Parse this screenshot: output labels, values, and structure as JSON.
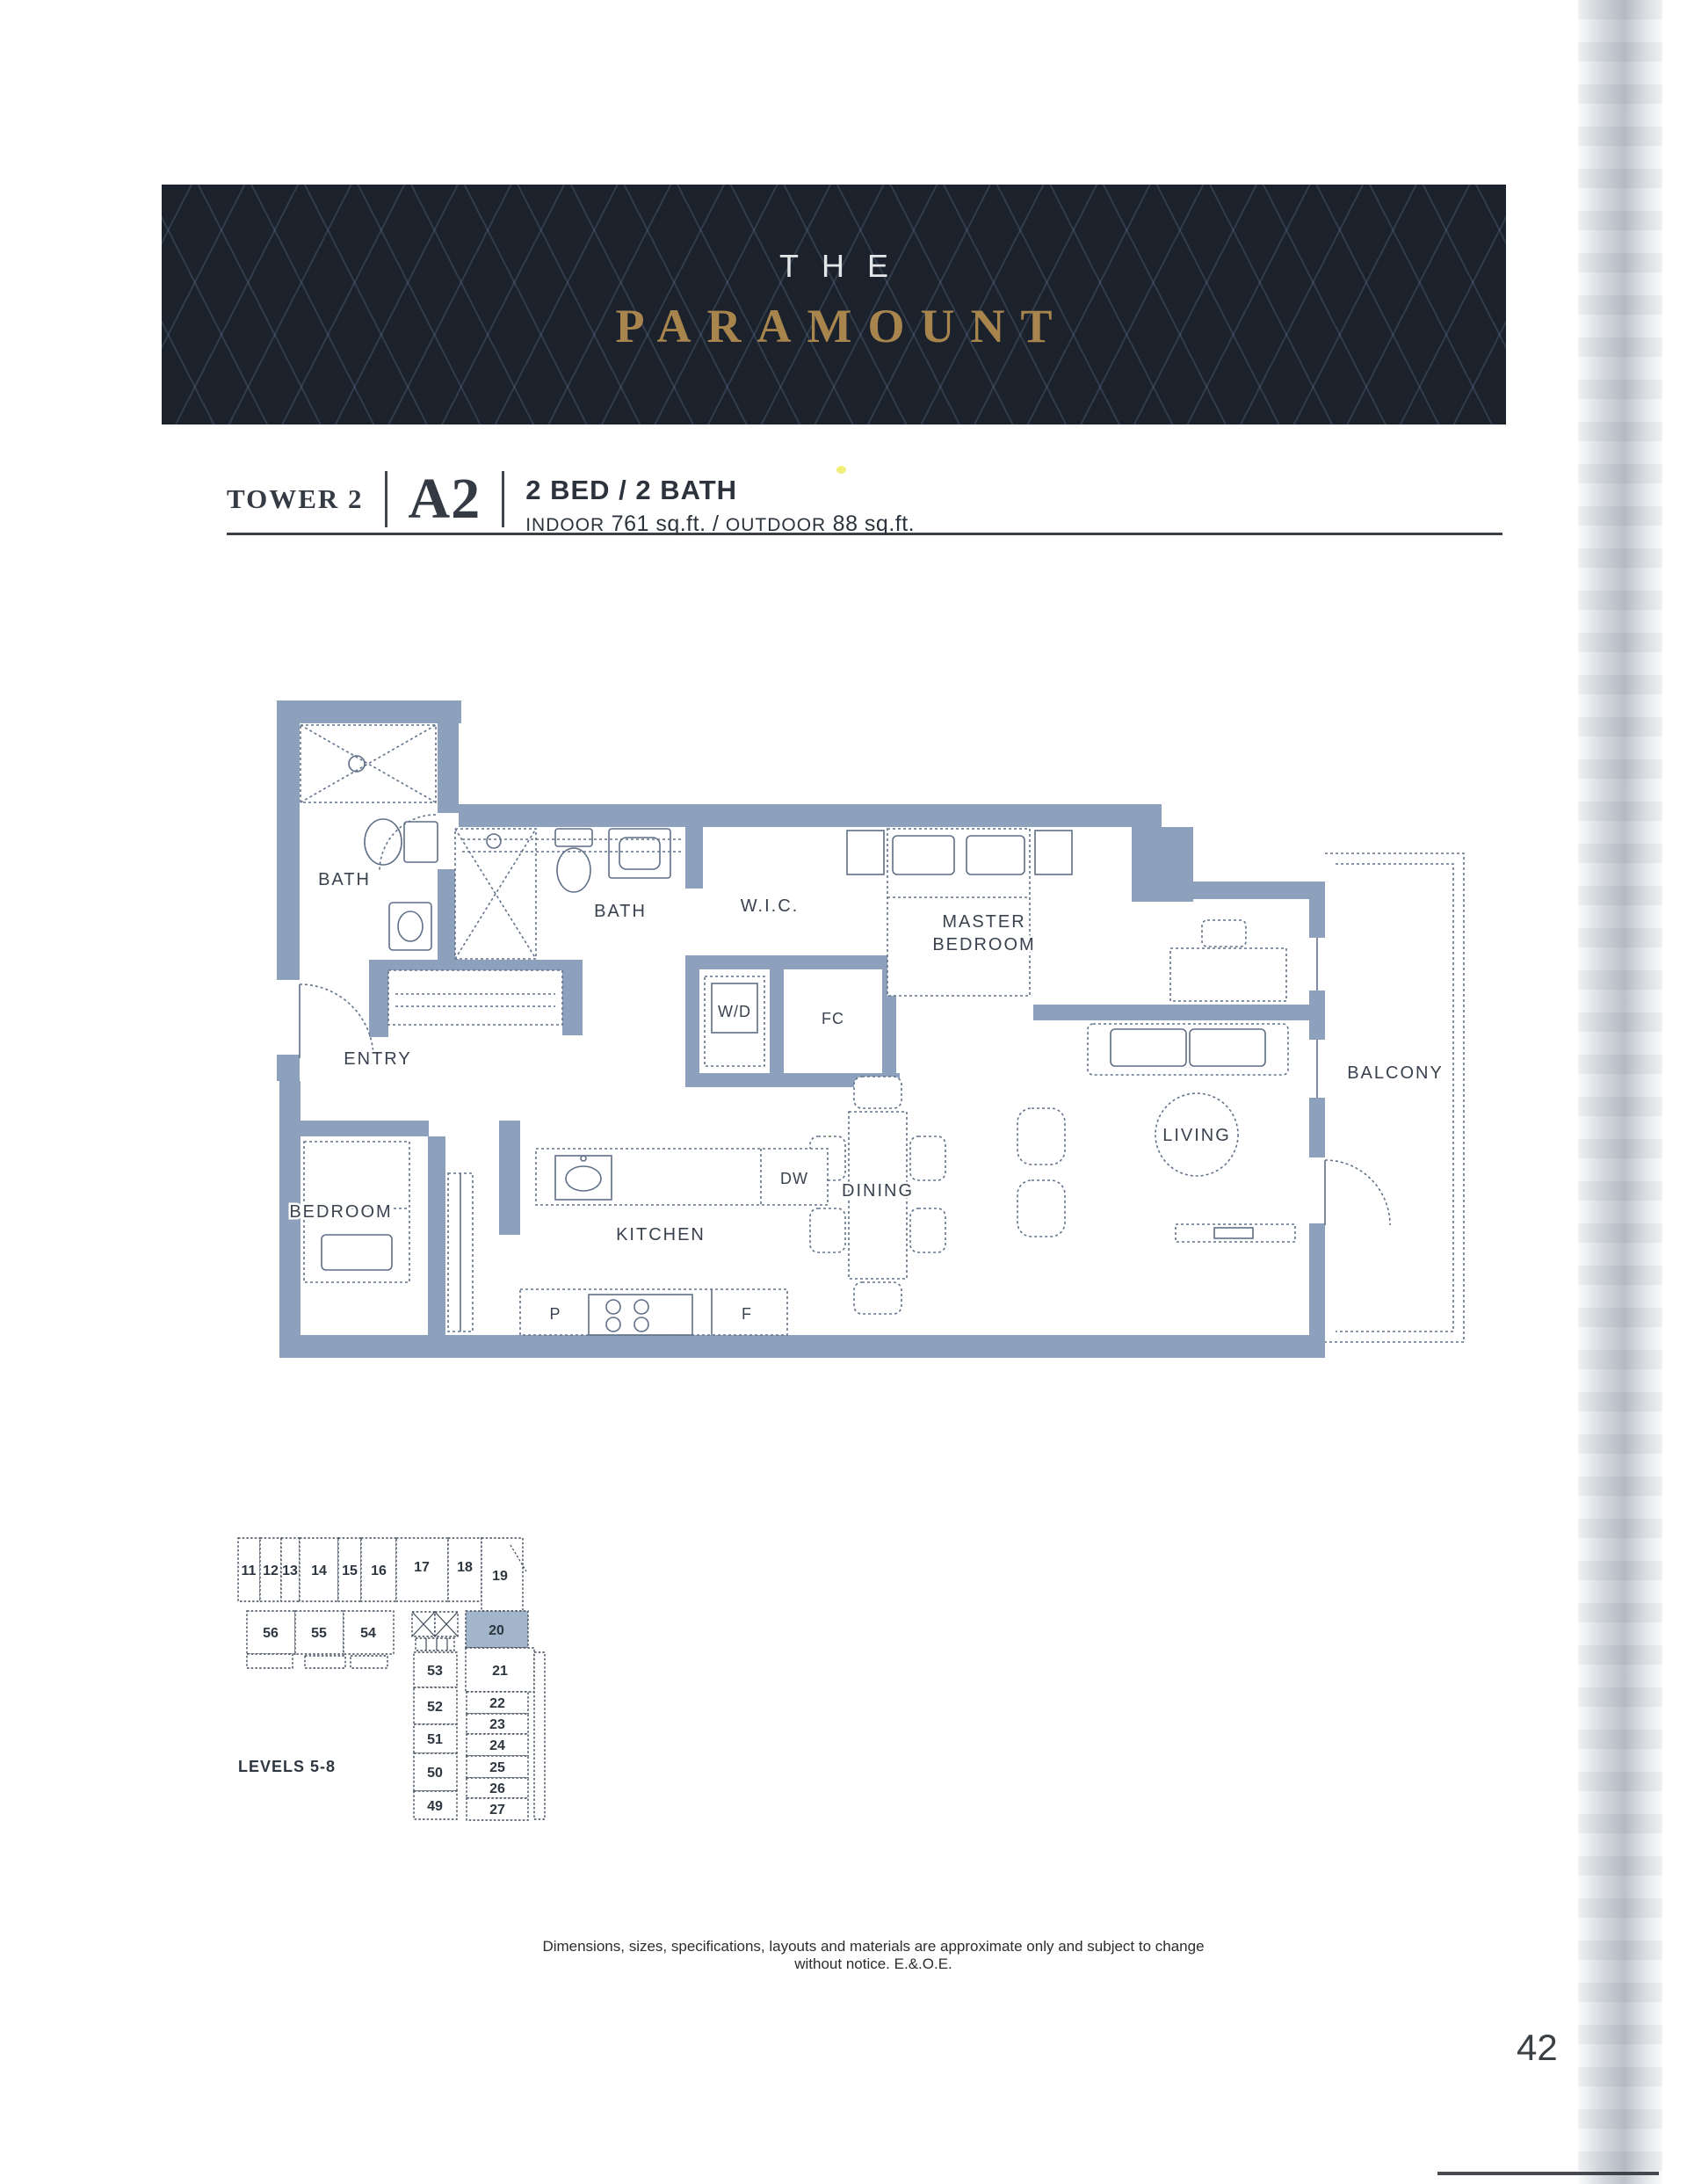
{
  "banner": {
    "pre_title": "THE",
    "title": "PARAMOUNT",
    "background_color": "#1c222c",
    "title_color": "#a9854e",
    "pre_title_color": "#e4e7e9"
  },
  "header": {
    "tower": "TOWER 2",
    "unit_code": "A2",
    "unit_type": "2 BED / 2 BATH",
    "area": {
      "indoor_label": "INDOOR",
      "indoor_value": "761 sq.ft.",
      "separator": "/",
      "outdoor_label": "OUTDOOR",
      "outdoor_value": "88 sq.ft."
    }
  },
  "floorplan": {
    "wall_color": "#8da1bc",
    "labels": {
      "bath_ensuite": "BATH",
      "bath_main": "BATH",
      "wic": "W.I.C.",
      "master_line1": "MASTER",
      "master_line2": "BEDROOM",
      "washer_dryer": "W/D",
      "fan_coil": "FC",
      "entry": "ENTRY",
      "bedroom": "BEDROOM",
      "kitchen": "KITCHEN",
      "dining": "DINING",
      "living": "LIVING",
      "balcony": "BALCONY",
      "dishwasher": "DW",
      "pantry": "P",
      "fridge": "F"
    }
  },
  "keyplan": {
    "levels_label": "LEVELS 5-8",
    "highlight_color": "#a2b5ca",
    "highlighted_unit": "20",
    "top_row": [
      "11",
      "12",
      "13",
      "14",
      "15",
      "16",
      "17",
      "18",
      "19"
    ],
    "second_row": [
      "56",
      "55",
      "54"
    ],
    "left_column": [
      "53",
      "52",
      "51",
      "50",
      "49"
    ],
    "right_column": [
      "21",
      "22",
      "23",
      "24",
      "25",
      "26",
      "27"
    ]
  },
  "footer": {
    "disclaimer": "Dimensions, sizes, specifications, layouts and materials are approximate only and subject to change without notice. E.&.O.E.",
    "page_number": "42"
  }
}
